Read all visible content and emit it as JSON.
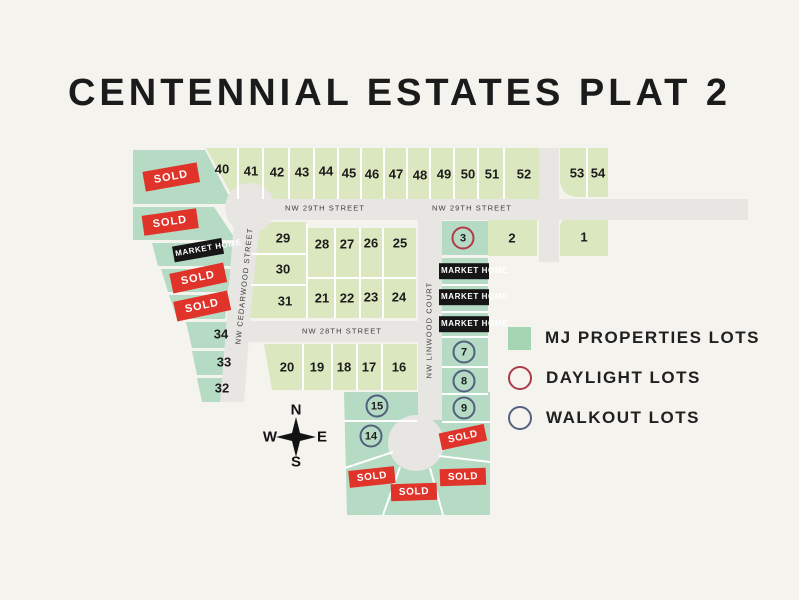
{
  "title": "CENTENNIAL ESTATES PLAT 2",
  "legend": {
    "items": [
      {
        "label": "MJ PROPERTIES LOTS",
        "swatch": "green-square",
        "color": "#a6d5b4"
      },
      {
        "label": "DAYLIGHT LOTS",
        "swatch": "red-circle-outline",
        "color": "#a93b4b"
      },
      {
        "label": "WALKOUT LOTS",
        "swatch": "blue-circle-outline",
        "color": "#556180"
      }
    ]
  },
  "compass": {
    "north": "N",
    "east": "E",
    "south": "S",
    "west": "W"
  },
  "colors": {
    "background": "#f5f3ee",
    "lot_light_green": "#dbe7bf",
    "lot_mint_green": "#b5dbc4",
    "street_gray": "#e8e6e3",
    "sold_red": "#e0342a",
    "market_home_black": "#161616",
    "daylight_circle_red": "#b23b47",
    "walkout_circle_blue": "#51607f"
  },
  "map": {
    "street_names": [
      "NW 29TH STREET",
      "NW 28TH STREET",
      "NW CEDARWOOD STREET",
      "NW LINWOOD COURT"
    ],
    "labels": [
      {
        "kind": "num",
        "text": "40",
        "x": 222,
        "y": 169
      },
      {
        "kind": "num",
        "text": "41",
        "x": 251,
        "y": 171
      },
      {
        "kind": "num",
        "text": "42",
        "x": 277,
        "y": 172
      },
      {
        "kind": "num",
        "text": "43",
        "x": 302,
        "y": 172
      },
      {
        "kind": "num",
        "text": "44",
        "x": 326,
        "y": 171
      },
      {
        "kind": "num",
        "text": "45",
        "x": 349,
        "y": 173
      },
      {
        "kind": "num",
        "text": "46",
        "x": 372,
        "y": 174
      },
      {
        "kind": "num",
        "text": "47",
        "x": 396,
        "y": 174
      },
      {
        "kind": "num",
        "text": "48",
        "x": 420,
        "y": 175
      },
      {
        "kind": "num",
        "text": "49",
        "x": 444,
        "y": 174
      },
      {
        "kind": "num",
        "text": "50",
        "x": 468,
        "y": 174
      },
      {
        "kind": "num",
        "text": "51",
        "x": 492,
        "y": 174
      },
      {
        "kind": "num",
        "text": "52",
        "x": 524,
        "y": 174
      },
      {
        "kind": "num",
        "text": "53",
        "x": 577,
        "y": 173
      },
      {
        "kind": "num",
        "text": "54",
        "x": 598,
        "y": 173
      },
      {
        "kind": "num",
        "text": "2",
        "x": 512,
        "y": 238
      },
      {
        "kind": "num",
        "text": "1",
        "x": 584,
        "y": 237
      },
      {
        "kind": "num",
        "text": "29",
        "x": 283,
        "y": 238
      },
      {
        "kind": "num",
        "text": "30",
        "x": 283,
        "y": 269
      },
      {
        "kind": "num",
        "text": "31",
        "x": 285,
        "y": 301
      },
      {
        "kind": "num",
        "text": "28",
        "x": 322,
        "y": 244
      },
      {
        "kind": "num",
        "text": "27",
        "x": 347,
        "y": 244
      },
      {
        "kind": "num",
        "text": "26",
        "x": 371,
        "y": 243
      },
      {
        "kind": "num",
        "text": "25",
        "x": 400,
        "y": 243
      },
      {
        "kind": "num",
        "text": "21",
        "x": 322,
        "y": 298
      },
      {
        "kind": "num",
        "text": "22",
        "x": 347,
        "y": 298
      },
      {
        "kind": "num",
        "text": "23",
        "x": 371,
        "y": 297
      },
      {
        "kind": "num",
        "text": "24",
        "x": 399,
        "y": 297
      },
      {
        "kind": "num",
        "text": "34",
        "x": 221,
        "y": 334
      },
      {
        "kind": "num",
        "text": "33",
        "x": 224,
        "y": 362
      },
      {
        "kind": "num",
        "text": "32",
        "x": 222,
        "y": 388
      },
      {
        "kind": "num",
        "text": "20",
        "x": 287,
        "y": 367
      },
      {
        "kind": "num",
        "text": "19",
        "x": 317,
        "y": 367
      },
      {
        "kind": "num",
        "text": "18",
        "x": 344,
        "y": 367
      },
      {
        "kind": "num",
        "text": "17",
        "x": 369,
        "y": 367
      },
      {
        "kind": "num",
        "text": "16",
        "x": 399,
        "y": 367
      },
      {
        "kind": "num-red",
        "text": "3",
        "x": 463,
        "y": 238
      },
      {
        "kind": "num-blue",
        "text": "7",
        "x": 464,
        "y": 352
      },
      {
        "kind": "num-blue",
        "text": "8",
        "x": 464,
        "y": 381
      },
      {
        "kind": "num-blue",
        "text": "9",
        "x": 464,
        "y": 408
      },
      {
        "kind": "num-blue",
        "text": "15",
        "x": 377,
        "y": 406
      },
      {
        "kind": "num-blue",
        "text": "14",
        "x": 371,
        "y": 436
      },
      {
        "kind": "sold",
        "text": "SOLD",
        "x": 171,
        "y": 177,
        "rot": -10
      },
      {
        "kind": "sold",
        "text": "SOLD",
        "x": 170,
        "y": 222,
        "rot": -8
      },
      {
        "kind": "sold",
        "text": "SOLD",
        "x": 198,
        "y": 278,
        "rot": -12
      },
      {
        "kind": "sold",
        "text": "SOLD",
        "x": 202,
        "y": 306,
        "rot": -12
      },
      {
        "kind": "sold-sm",
        "text": "SOLD",
        "x": 463,
        "y": 437,
        "rot": -12
      },
      {
        "kind": "sold-sm",
        "text": "SOLD",
        "x": 372,
        "y": 477,
        "rot": -6
      },
      {
        "kind": "sold-sm",
        "text": "SOLD",
        "x": 414,
        "y": 492,
        "rot": -2
      },
      {
        "kind": "sold-sm",
        "text": "SOLD",
        "x": 463,
        "y": 477,
        "rot": -2
      },
      {
        "kind": "market",
        "text": "MARKET HOME",
        "x": 198,
        "y": 250,
        "rot": -10
      },
      {
        "kind": "market",
        "text": "MARKET HOME",
        "x": 464,
        "y": 271
      },
      {
        "kind": "market",
        "text": "MARKET HOME",
        "x": 464,
        "y": 297
      },
      {
        "kind": "market",
        "text": "MARKET HOME",
        "x": 464,
        "y": 324
      },
      {
        "kind": "street-h",
        "text": "NW 29TH STREET",
        "x": 325,
        "y": 208
      },
      {
        "kind": "street-h",
        "text": "NW 29TH STREET",
        "x": 472,
        "y": 208
      },
      {
        "kind": "street-h",
        "text": "NW 28TH STREET",
        "x": 342,
        "y": 331
      },
      {
        "kind": "street-v",
        "text": "NW CEDARWOOD STREET",
        "x": 244,
        "y": 286,
        "rot": -84
      },
      {
        "kind": "street-v",
        "text": "NW LINWOOD COURT",
        "x": 429,
        "y": 330,
        "rot": -90
      }
    ]
  }
}
